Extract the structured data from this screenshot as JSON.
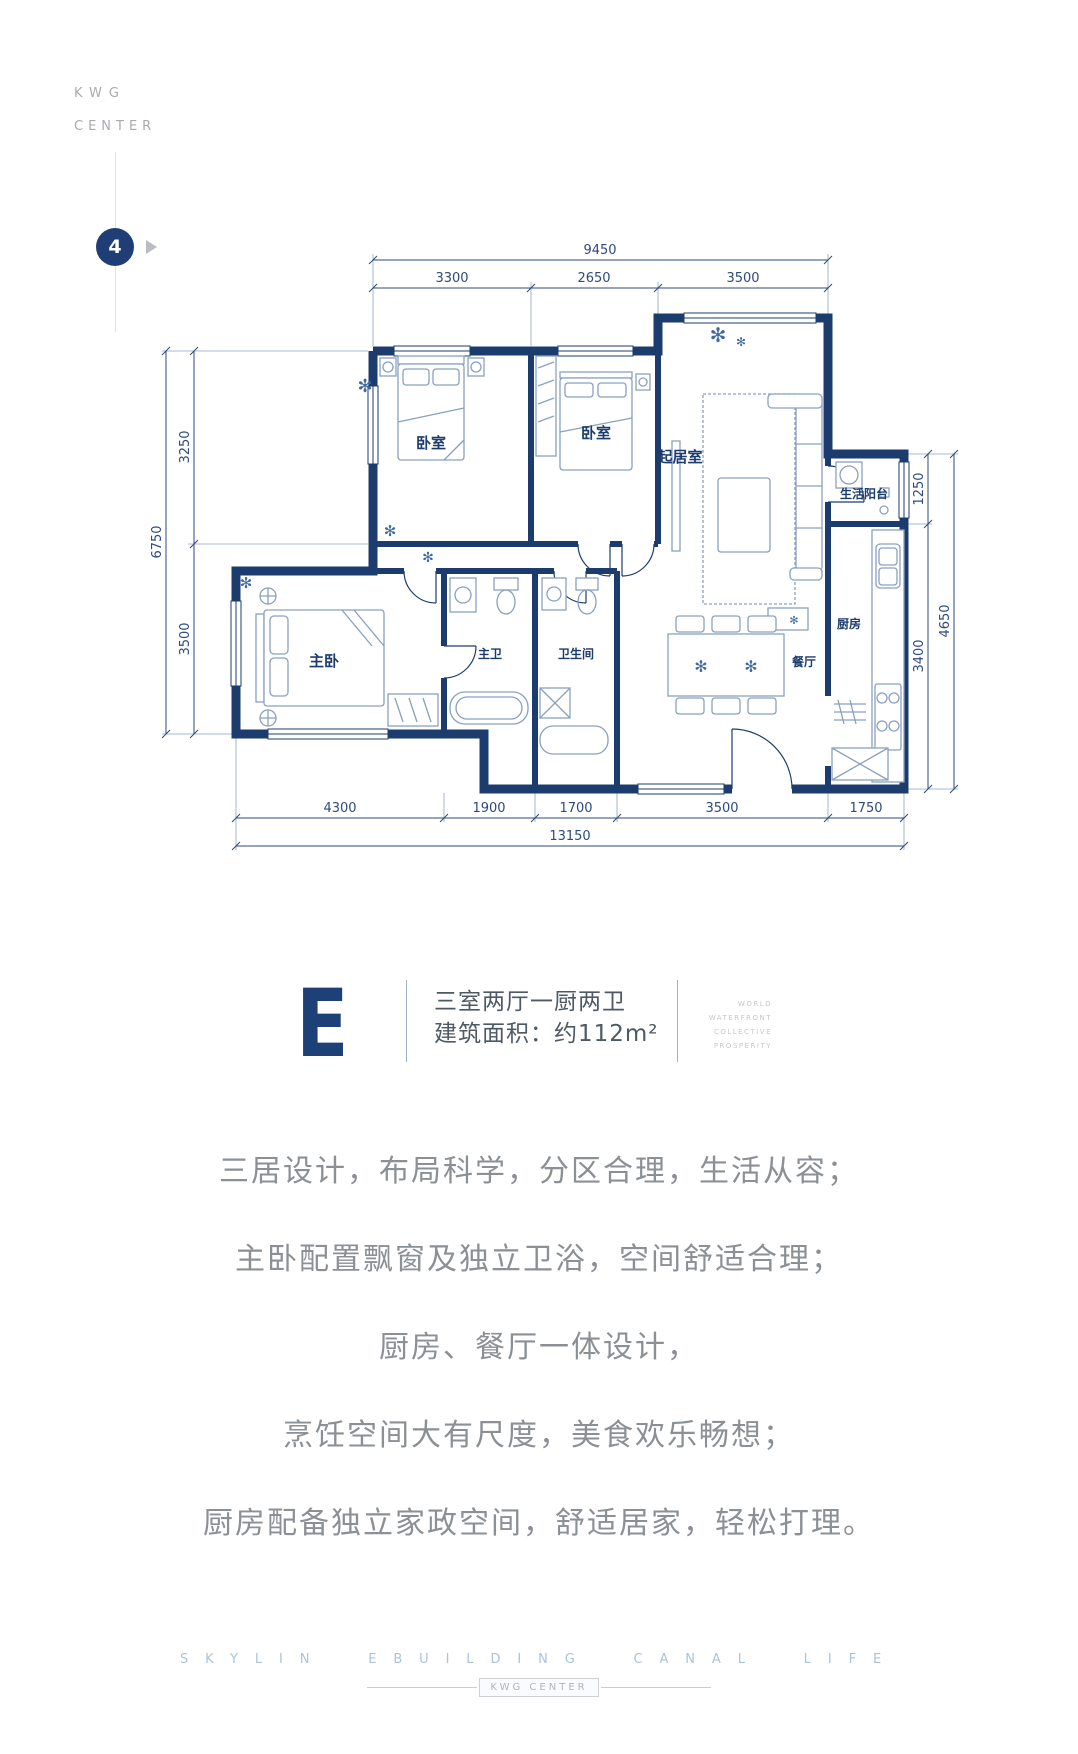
{
  "brand": {
    "line1": "KWG",
    "line2": "CENTER",
    "marker": "4"
  },
  "icons": {
    "plant": "✻"
  },
  "floorplan": {
    "rooms": {
      "bedroom1": "卧室",
      "bedroom2": "卧室",
      "living": "起居室",
      "balcony": "生活阳台",
      "kitchen": "厨房",
      "master": "主卧",
      "master_bath": "主卫",
      "bath": "卫生间",
      "dining": "餐厅"
    },
    "dims": {
      "top_total": "9450",
      "top1": "3300",
      "top2": "2650",
      "top3": "3500",
      "left_total": "6750",
      "left1": "3250",
      "left2": "3500",
      "right_total": "4650",
      "right1": "1250",
      "right2": "3400",
      "bottom1": "4300",
      "bottom2": "1900",
      "bottom3": "1700",
      "bottom4": "3500",
      "bottom5": "1750",
      "bottom_total": "13150"
    }
  },
  "unit": {
    "letter": "E",
    "layout": "三室两厅一厨两卫",
    "area": "建筑面积：约112m²",
    "tagline1": "WORLD",
    "tagline2": "WATERFRONT",
    "tagline3": "COLLECTIVE",
    "tagline4": "PROSPERITY"
  },
  "description": {
    "line1": "三居设计，布局科学，分区合理，生活从容；",
    "line2": "主卧配置飘窗及独立卫浴，空间舒适合理；",
    "line3": "厨房、餐厅一体设计，",
    "line4": "烹饪空间大有尺度，美食欢乐畅想；",
    "line5": "厨房配备独立家政空间，舒适居家，轻松打理。"
  },
  "footer": {
    "tagline": "SKYLIN EBUILDING CANAL LIFE",
    "badge": "KWG CENTER"
  }
}
